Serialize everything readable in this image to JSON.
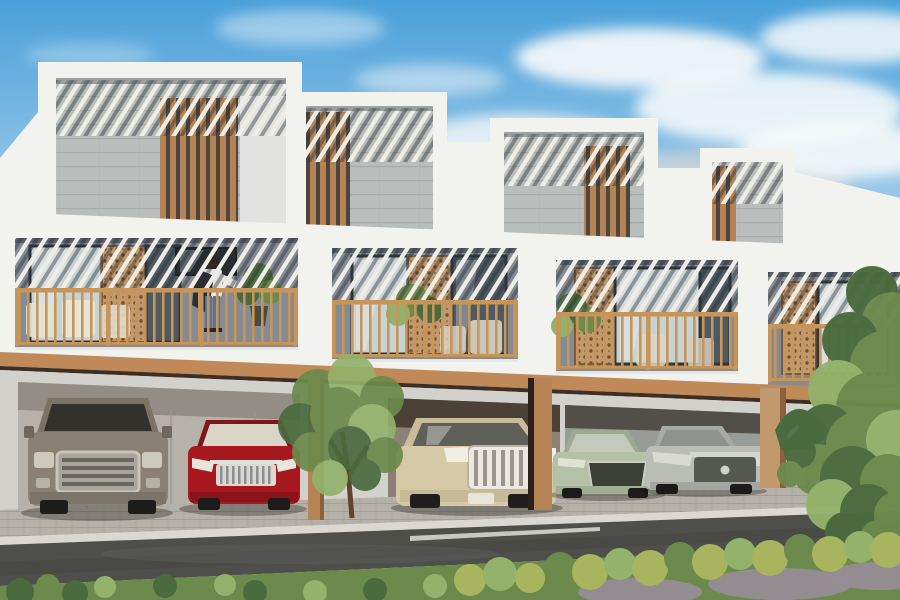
{
  "scene": {
    "description": "Architectural render: front elevation of a row of four modern two-storey townhouses with rooftop pergolas, grey stone panels, wooden slat screens, balconies with timber railings, and ground-floor carports facing a street.",
    "units": 4,
    "cars_count": 5,
    "person_on_balcony": true
  },
  "palette": {
    "sky_top": "#49a0da",
    "sky_mid": "#9ecbe9",
    "sky_low": "#dcebf4",
    "cloud_white": "#f7f9fa",
    "cloud_gray": "#ccd3d9",
    "wall_white": "#f2f2ef",
    "wall_white_shade": "#e2e3e0",
    "concrete": "#b9bdbb",
    "recess_wall": "#848b93",
    "recess_dark": "#575e66",
    "wood": "#b58354",
    "wood_light": "#c2996d",
    "wood_dark": "#8a6138",
    "rail": "#c79559",
    "trim": "#c08a58",
    "trim_shadow": "#3e2e24",
    "glass_light": "#c7d2d3",
    "glass_dark": "#4e5a62",
    "frame_dark": "#2f373b",
    "ground_wall": "#d2d1cc",
    "bay_light": "#b6b2aa",
    "bay_warm": "#8d8175",
    "bay_cool": "#979c98",
    "bay_shadow": "#4b4136",
    "pavers": "#b5b1a8",
    "curb": "#dad8d1",
    "road": "#4e4e4a",
    "road_line": "#d6d7cf",
    "green_dark": "#4a6b3e",
    "green_mid": "#6c8a4c",
    "green_light": "#93b26b",
    "green_yellow": "#a9b45e",
    "gravel": "#968c94",
    "planter": "#eceae4",
    "shirt": "#e8e6e2",
    "jeans": "#5b7396",
    "hair": "#2e2620",
    "bag": "#2b2f33"
  },
  "cars": [
    {
      "name": "suv-grey-brown",
      "color": "#8a8073"
    },
    {
      "name": "sedan-red",
      "color": "#a6181e"
    },
    {
      "name": "suv-beige",
      "color": "#d5c9a6"
    },
    {
      "name": "sedan-light-green",
      "color": "#b3c1a6"
    },
    {
      "name": "sedan-silver",
      "color": "#babdb6"
    }
  ]
}
